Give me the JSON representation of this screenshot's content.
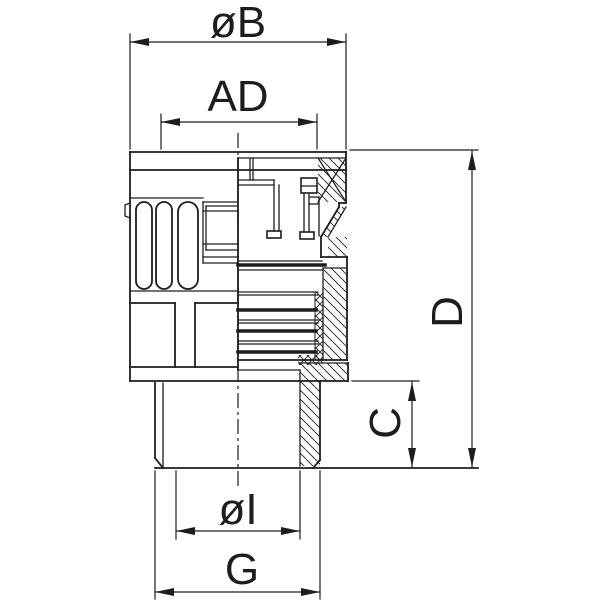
{
  "drawing": {
    "kind": "dimensioned technical section drawing of a conduit fitting / cable gland",
    "view": "half outside view (left), half cross-section (right)"
  },
  "labels": {
    "outer_diameter": "øB",
    "cap_inner_width": "AD",
    "overall_height": "D",
    "spigot_height": "C",
    "inner_diameter": "øI",
    "thread_size": "G"
  },
  "colors": {
    "line": "#1d1d1b",
    "background": "#ffffff"
  }
}
